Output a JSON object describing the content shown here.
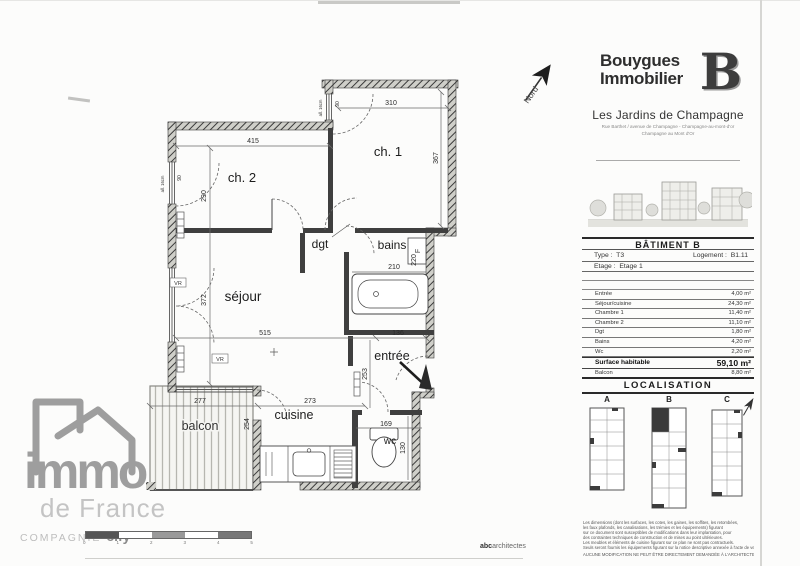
{
  "north": {
    "label": "Nord"
  },
  "plan": {
    "rooms": {
      "ch2": "ch. 2",
      "ch1": "ch. 1",
      "dgt": "dgt",
      "bains": "bains",
      "sejour": "séjour",
      "entree": "entrée",
      "cuisine": "cuisine",
      "wc": "wc",
      "balcon": "balcon"
    },
    "dims": {
      "d415": "415",
      "d310": "310",
      "d367": "367",
      "d290": "290",
      "d210": "210",
      "d220": "220",
      "d515": "515",
      "d136": "136",
      "d372": "372",
      "d253": "253",
      "d273": "273",
      "d277": "277",
      "d254": "254",
      "d169": "169",
      "d130": "130",
      "win90": "90",
      "sill": "all. 16cm",
      "vr": "VR",
      "f": "F"
    }
  },
  "panel": {
    "brand": {
      "line1": "Bouygues",
      "line2": "Immobilier",
      "mark": "B"
    },
    "residence": "Les Jardins de Champagne",
    "address1": "Rue Barthet / avenue de Champagne - Champagne-au-mont-d'or",
    "address2": "Champagne au Mont d'Or",
    "batiment": {
      "title": "BÂTIMENT B",
      "type_label": "Type :",
      "type_value": "T3",
      "logement_label": "Logement :",
      "logement_value": "B1.11",
      "etage_label": "Etage :",
      "etage_value": "Etage 1"
    },
    "areas": {
      "rows": [
        {
          "label": "Entrée",
          "value": "4,00 m²"
        },
        {
          "label": "Séjour/cuisine",
          "value": "24,30 m²"
        },
        {
          "label": "Chambre 1",
          "value": "11,40 m²"
        },
        {
          "label": "Chambre 2",
          "value": "11,10 m²"
        },
        {
          "label": "Dgt",
          "value": "1,80 m²"
        },
        {
          "label": "Bains",
          "value": "4,20 m²"
        },
        {
          "label": "Wc",
          "value": "2,20 m²"
        }
      ],
      "total_label": "Surface habitable",
      "total_value": "59,10 m²",
      "balcon_label": "Balcon",
      "balcon_value": "8,80 m²"
    },
    "localisation": {
      "title": "LOCALISATION",
      "a": "A",
      "b": "B",
      "c": "C"
    },
    "disclaimer": [
      "Les dimensions (dont les surfaces, les cotes, les gaines, les soffites, les retombées,",
      "les faux plafonds, les canalisations, les trémies et les équipements) figurant",
      "sur ce document sont susceptibles de modifications dans leur implantation, pour",
      "des contraintes techniques de construction et de mises au point ultérieures.",
      "Les meubles et éléments de cuisine figurant sur ce plan ne sont pas contractuels.",
      "Seuls seront fournis les équipements figurant sur la notice descriptive annexée à l'acte de vente.",
      "AUCUNE MODIFICATION NE PEUT ÊTRE DIRECTEMENT DEMANDÉE À L'ARCHITECTE."
    ]
  },
  "footer": {
    "immo": "immo",
    "de_france": "de France",
    "compagnie": "COMPAGNIE",
    "cify": "cify",
    "architect_prefix": "abc",
    "architect_suffix": "architectes",
    "scale_ticks": [
      "0",
      "1",
      "2",
      "3",
      "4",
      "5"
    ]
  }
}
